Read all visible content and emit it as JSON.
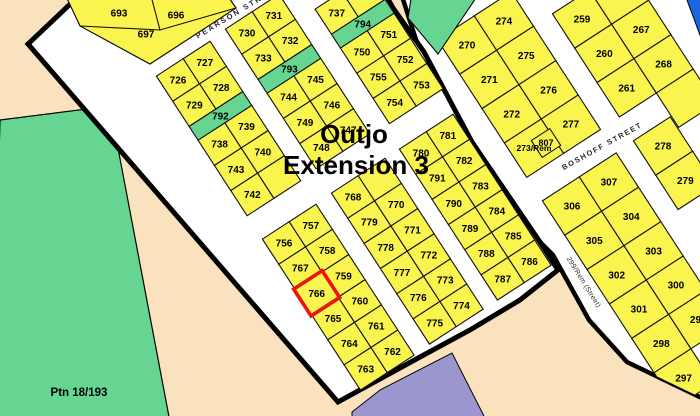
{
  "map": {
    "title_line1": "Outjo",
    "title_line2": "Extension 3",
    "title": {
      "x1": 354,
      "y1": 143,
      "x2": 356,
      "y2": 174,
      "size": 26
    }
  },
  "colors": {
    "background": "#FBE2BE",
    "parcel_yellow": "#FAF44E",
    "green": "#66D592",
    "street_white": "#FFFFFF",
    "blue": "#1B66E0",
    "purple": "#9B97CE",
    "boundary_black": "#000000",
    "cell_stroke": "#111111",
    "highlight_red": "#EE1409",
    "label_black": "#000000",
    "street_label": "#2B2B2B"
  },
  "region_labels": {
    "ptn": {
      "text": "Ptn 18/193",
      "x": 79,
      "y": 396,
      "size": 11.5
    },
    "erf_807": {
      "text": "807",
      "x": 546,
      "y": 143
    }
  },
  "street_labels": [
    {
      "name": "pearson-street",
      "label": "PEARSON STRE",
      "x": 232,
      "y": 15,
      "angle": -31,
      "size": 7.5,
      "ls": 2,
      "bold": true
    },
    {
      "name": "boshoff-street",
      "label": "BOSHOFF STREET",
      "x": 602,
      "y": 146,
      "angle": -29,
      "size": 7.5,
      "ls": 1.6,
      "bold": true
    },
    {
      "name": "299-rem-street",
      "label": "299/Rem (Street)",
      "x": 584,
      "y": 282,
      "angle": 58,
      "size": 7,
      "ls": 0.3,
      "bold": false
    }
  ],
  "boundaries": {
    "extension": [
      [
        85,
        -10
      ],
      [
        383,
        -10
      ],
      [
        393,
        8
      ],
      [
        424,
        52
      ],
      [
        456,
        112
      ],
      [
        472,
        142
      ],
      [
        540,
        242
      ],
      [
        558,
        270
      ],
      [
        520,
        300
      ],
      [
        470,
        330
      ],
      [
        420,
        357
      ],
      [
        338,
        402
      ],
      [
        28,
        44
      ]
    ],
    "oldtown": [
      [
        400,
        -10
      ],
      [
        710,
        -10
      ],
      [
        710,
        402
      ],
      [
        627,
        362
      ],
      [
        589,
        320
      ],
      [
        553,
        255
      ],
      [
        534,
        236
      ],
      [
        466,
        136
      ],
      [
        450,
        106
      ],
      [
        418,
        46
      ]
    ]
  },
  "regions": [
    {
      "name": "ptn-18-193-parcel",
      "fill": "green",
      "points": [
        [
          0,
          120
        ],
        [
          110,
          106
        ],
        [
          170,
          422
        ],
        [
          -8,
          422
        ]
      ]
    },
    {
      "name": "park-parcel",
      "fill": "green",
      "points": [
        [
          412,
          -8
        ],
        [
          480,
          -8
        ],
        [
          438,
          54
        ],
        [
          408,
          18
        ]
      ]
    },
    {
      "name": "blue-corner-parcel",
      "fill": "blue",
      "points": [
        [
          684,
          -8
        ],
        [
          710,
          -8
        ],
        [
          710,
          62
        ]
      ]
    },
    {
      "name": "purple-parcel",
      "fill": "purple",
      "points": [
        [
          352,
          412
        ],
        [
          380,
          390
        ],
        [
          452,
          353
        ],
        [
          486,
          420
        ],
        [
          352,
          420
        ]
      ]
    }
  ],
  "block_a": {
    "outline": [
      [
        64,
        -8
      ],
      [
        225,
        -8
      ],
      [
        236,
        8
      ],
      [
        150,
        64
      ],
      [
        80,
        26
      ]
    ],
    "dividers": [
      [
        [
          150,
          -8
        ],
        [
          160,
          30
        ]
      ],
      [
        [
          80,
          26
        ],
        [
          160,
          30
        ],
        [
          236,
          8
        ]
      ]
    ],
    "labels": [
      {
        "n": "693",
        "x": 119,
        "y": 13
      },
      {
        "n": "696",
        "x": 176,
        "y": 15
      },
      {
        "n": "697",
        "x": 146,
        "y": 34
      }
    ]
  },
  "extra_cells": [
    {
      "n": "807",
      "points": [
        [
          531.3,
          140.6
        ],
        [
          549.8,
          128.6
        ],
        [
          560.7,
          145.4
        ],
        [
          542.2,
          157.4
        ]
      ],
      "lx": 546,
      "ly": 143,
      "oldtown": true
    }
  ],
  "blocks": [
    {
      "id": "block-726",
      "x": 156.4,
      "y": 76.1,
      "angle": -33,
      "cw": 32,
      "ch": 30,
      "rows": [
        {
          "cells": [
            {
              "n": "726"
            },
            {
              "n": "727"
            }
          ]
        },
        {
          "cells": [
            {
              "n": "729"
            },
            {
              "n": "728"
            }
          ]
        },
        {
          "h": 0.55,
          "cells": [
            {
              "n": "792",
              "green": true,
              "span": 2
            }
          ]
        },
        {
          "cells": [
            {
              "n": "738"
            },
            {
              "n": "739"
            }
          ]
        },
        {
          "cells": [
            {
              "n": "743"
            },
            {
              "n": "740"
            }
          ]
        },
        {
          "cells": [
            {
              "n": "742"
            },
            {
              "n": ""
            }
          ]
        }
      ]
    },
    {
      "id": "block-730",
      "x": 225.4,
      "y": 29.1,
      "angle": -33,
      "cw": 32,
      "ch": 30,
      "rows": [
        {
          "cells": [
            {
              "n": "730"
            },
            {
              "n": "731"
            }
          ]
        },
        {
          "cells": [
            {
              "n": "733"
            },
            {
              "n": "732"
            }
          ]
        },
        {
          "h": 0.55,
          "cells": [
            {
              "n": "793",
              "green": true,
              "span": 2
            }
          ]
        },
        {
          "cells": [
            {
              "n": "744"
            },
            {
              "n": "745"
            }
          ]
        },
        {
          "cells": [
            {
              "n": "749"
            },
            {
              "n": "746"
            }
          ]
        },
        {
          "cells": [
            {
              "n": "748"
            },
            {
              "n": "747"
            }
          ]
        }
      ]
    },
    {
      "id": "block-737",
      "x": 315.1,
      "y": 9.1,
      "angle": -33,
      "cw": 32,
      "ch": 30,
      "rows": [
        {
          "cells": [
            {
              "n": "737"
            },
            {
              "n": ""
            }
          ]
        },
        {
          "h": 0.55,
          "cells": [
            {
              "n": "794",
              "green": true,
              "span": 2
            }
          ]
        },
        {
          "cells": [
            {
              "n": "750"
            },
            {
              "n": "751"
            }
          ]
        },
        {
          "cells": [
            {
              "n": "755"
            },
            {
              "n": "752"
            }
          ]
        },
        {
          "cells": [
            {
              "n": "754"
            },
            {
              "n": "753"
            }
          ]
        }
      ]
    },
    {
      "id": "block-756",
      "x": 262.4,
      "y": 239.1,
      "angle": -33,
      "cw": 32,
      "ch": 30,
      "rows": [
        {
          "cells": [
            {
              "n": "756"
            },
            {
              "n": "757"
            }
          ]
        },
        {
          "cells": [
            {
              "n": "767"
            },
            {
              "n": "758"
            }
          ]
        },
        {
          "cells": [
            {
              "n": "766",
              "highlight": true
            },
            {
              "n": "759"
            }
          ]
        },
        {
          "cells": [
            {
              "n": "765"
            },
            {
              "n": "760"
            }
          ]
        },
        {
          "cells": [
            {
              "n": "764"
            },
            {
              "n": "761"
            }
          ]
        },
        {
          "cells": [
            {
              "n": "763"
            },
            {
              "n": "762"
            }
          ]
        }
      ]
    },
    {
      "id": "block-768",
      "x": 331.4,
      "y": 193.1,
      "angle": -33,
      "cw": 32,
      "ch": 30,
      "rows": [
        {
          "cells": [
            {
              "n": "768"
            },
            {
              "n": ""
            }
          ]
        },
        {
          "cells": [
            {
              "n": "779"
            },
            {
              "n": "770"
            }
          ]
        },
        {
          "cells": [
            {
              "n": "778"
            },
            {
              "n": "771"
            }
          ]
        },
        {
          "cells": [
            {
              "n": "777"
            },
            {
              "n": "772"
            }
          ]
        },
        {
          "cells": [
            {
              "n": "776"
            },
            {
              "n": "773"
            }
          ]
        },
        {
          "cells": [
            {
              "n": "775"
            },
            {
              "n": "774"
            }
          ]
        }
      ]
    },
    {
      "id": "block-780",
      "x": 399.4,
      "y": 149.1,
      "angle": -33,
      "cw": 32,
      "ch": 30,
      "rows": [
        {
          "cells": [
            {
              "n": "780"
            },
            {
              "n": "781"
            }
          ]
        },
        {
          "cells": [
            {
              "n": "791"
            },
            {
              "n": "782"
            }
          ]
        },
        {
          "cells": [
            {
              "n": "790"
            },
            {
              "n": "783"
            }
          ]
        },
        {
          "cells": [
            {
              "n": "789"
            },
            {
              "n": "784"
            }
          ]
        },
        {
          "cells": [
            {
              "n": "788"
            },
            {
              "n": "785"
            }
          ]
        },
        {
          "cells": [
            {
              "n": "787"
            },
            {
              "n": "786"
            }
          ]
        }
      ]
    },
    {
      "id": "block-270",
      "oldtown": true,
      "x": 437.4,
      "y": 39.8,
      "angle": -33,
      "cw": 44,
      "ch": 41,
      "rows": [
        {
          "cells": [
            {
              "n": "270"
            },
            {
              "n": "274"
            }
          ]
        },
        {
          "cells": [
            {
              "n": "271"
            },
            {
              "n": "275"
            }
          ]
        },
        {
          "cells": [
            {
              "n": "272"
            },
            {
              "n": "276"
            }
          ]
        },
        {
          "cells": [
            {
              "n": "273/Rem",
              "small": true
            },
            {
              "n": "277"
            }
          ]
        }
      ]
    },
    {
      "id": "block-259",
      "oldtown": true,
      "x": 552.4,
      "y": 13.8,
      "angle": -33,
      "cw": 44,
      "ch": 41,
      "rows": [
        {
          "cells": [
            {
              "n": "259"
            },
            {
              "n": ""
            }
          ]
        },
        {
          "cells": [
            {
              "n": "260"
            },
            {
              "n": "267"
            }
          ]
        },
        {
          "cells": [
            {
              "n": "261"
            },
            {
              "n": "268"
            }
          ]
        },
        {
          "cells": [
            null,
            {
              "n": ""
            }
          ]
        }
      ]
    },
    {
      "id": "block-306",
      "oldtown": true,
      "x": 542.4,
      "y": 200.8,
      "angle": -33,
      "cw": 44,
      "ch": 41,
      "rows": [
        {
          "cells": [
            {
              "n": "306"
            },
            {
              "n": "307"
            }
          ]
        },
        {
          "cells": [
            {
              "n": "305"
            },
            {
              "n": "304"
            }
          ]
        },
        {
          "cells": [
            {
              "n": "302"
            },
            {
              "n": "303"
            }
          ]
        },
        {
          "cells": [
            {
              "n": "301"
            },
            {
              "n": "300"
            }
          ]
        },
        {
          "cells": [
            {
              "n": "298"
            },
            {
              "n": "299"
            }
          ]
        },
        {
          "cells": [
            {
              "n": "297"
            },
            null
          ]
        }
      ]
    },
    {
      "id": "block-278",
      "oldtown": true,
      "x": 633.4,
      "y": 140.8,
      "angle": -33,
      "cw": 44,
      "ch": 41,
      "rows": [
        {
          "cells": [
            {
              "n": "278"
            }
          ]
        },
        {
          "cells": [
            {
              "n": "279"
            }
          ]
        }
      ]
    }
  ]
}
